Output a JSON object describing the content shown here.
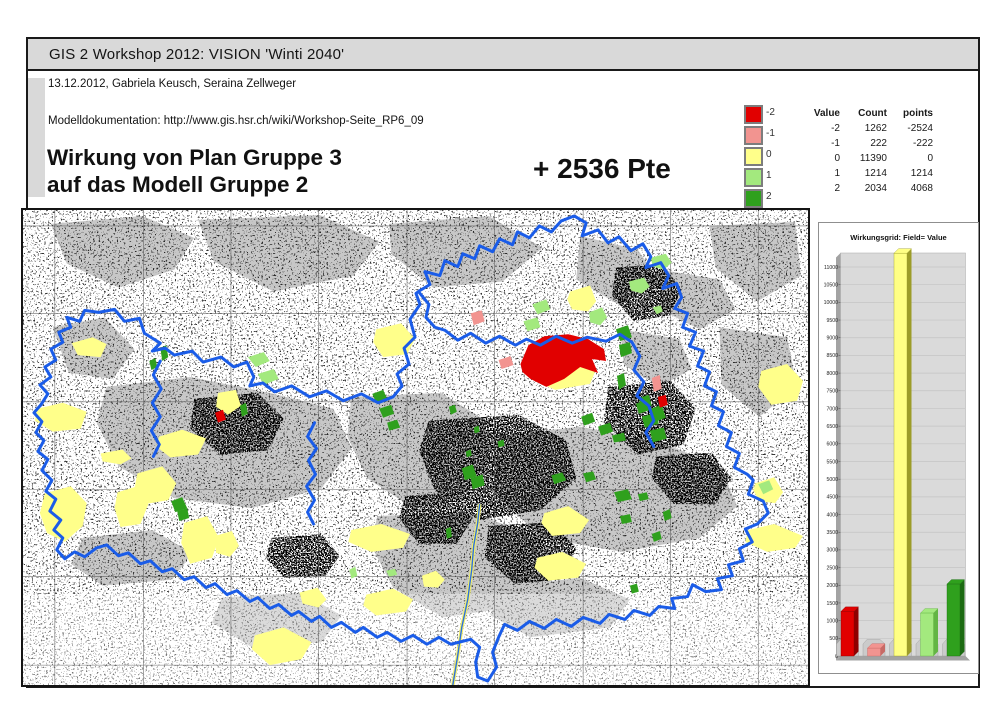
{
  "header": {
    "band_title": "GIS 2 Workshop 2012: VISION 'Winti 2040'",
    "authors_line": "13.12.2012, Gabriela Keusch, Seraina Zellweger",
    "doc_line": "Modelldokumentation: http://www.gis.hsr.ch/wiki/Workshop-Seite_RP6_09",
    "title_line1": "Wirkung von Plan Gruppe 3",
    "title_line2": "auf das Modell Gruppe 2",
    "score": "+ 2536 Pte"
  },
  "legend": {
    "items": [
      {
        "label": "-2",
        "color": "#e10000"
      },
      {
        "label": "-1",
        "color": "#f29490"
      },
      {
        "label": "0",
        "color": "#ffff8a"
      },
      {
        "label": "1",
        "color": "#a3e97e"
      },
      {
        "label": "2",
        "color": "#2fa01d"
      }
    ],
    "table": {
      "headers": [
        "Value",
        "Count",
        "points"
      ],
      "rows": [
        [
          "-2",
          "1262",
          "-2524"
        ],
        [
          "-1",
          "222",
          "-222"
        ],
        [
          "0",
          "11390",
          "0"
        ],
        [
          "1",
          "1214",
          "1214"
        ],
        [
          "2",
          "2034",
          "4068"
        ]
      ]
    }
  },
  "map": {
    "city_label": "WINTERTHUR"
  },
  "chart_data": {
    "type": "bar",
    "title": "Wirkungsgrid: Field= Value",
    "categories": [
      "-2",
      "-1",
      "0",
      "1",
      "2"
    ],
    "values": [
      1262,
      222,
      11390,
      1214,
      2034
    ],
    "bar_colors": [
      "#e10000",
      "#f29490",
      "#ffff84",
      "#a3e97e",
      "#2fa01d"
    ],
    "bar_side_colors": [
      "#8f0000",
      "#c76a66",
      "#9c9c28",
      "#63b544",
      "#1c6a12"
    ],
    "xlabel": "",
    "ylabel": "",
    "ylim": [
      0,
      11500
    ],
    "ytick_step": 500,
    "ytick_max": 11000,
    "grid": true,
    "plot_bg": "#dadada",
    "legend_position": "none"
  },
  "colors": {
    "neg2": "#e10000",
    "neg1": "#f29490",
    "zero": "#ffff8a",
    "pos1": "#a3e97e",
    "pos2": "#2fa01d",
    "boundary": "#1a5ce8",
    "band_bg": "#d9d9d9"
  }
}
